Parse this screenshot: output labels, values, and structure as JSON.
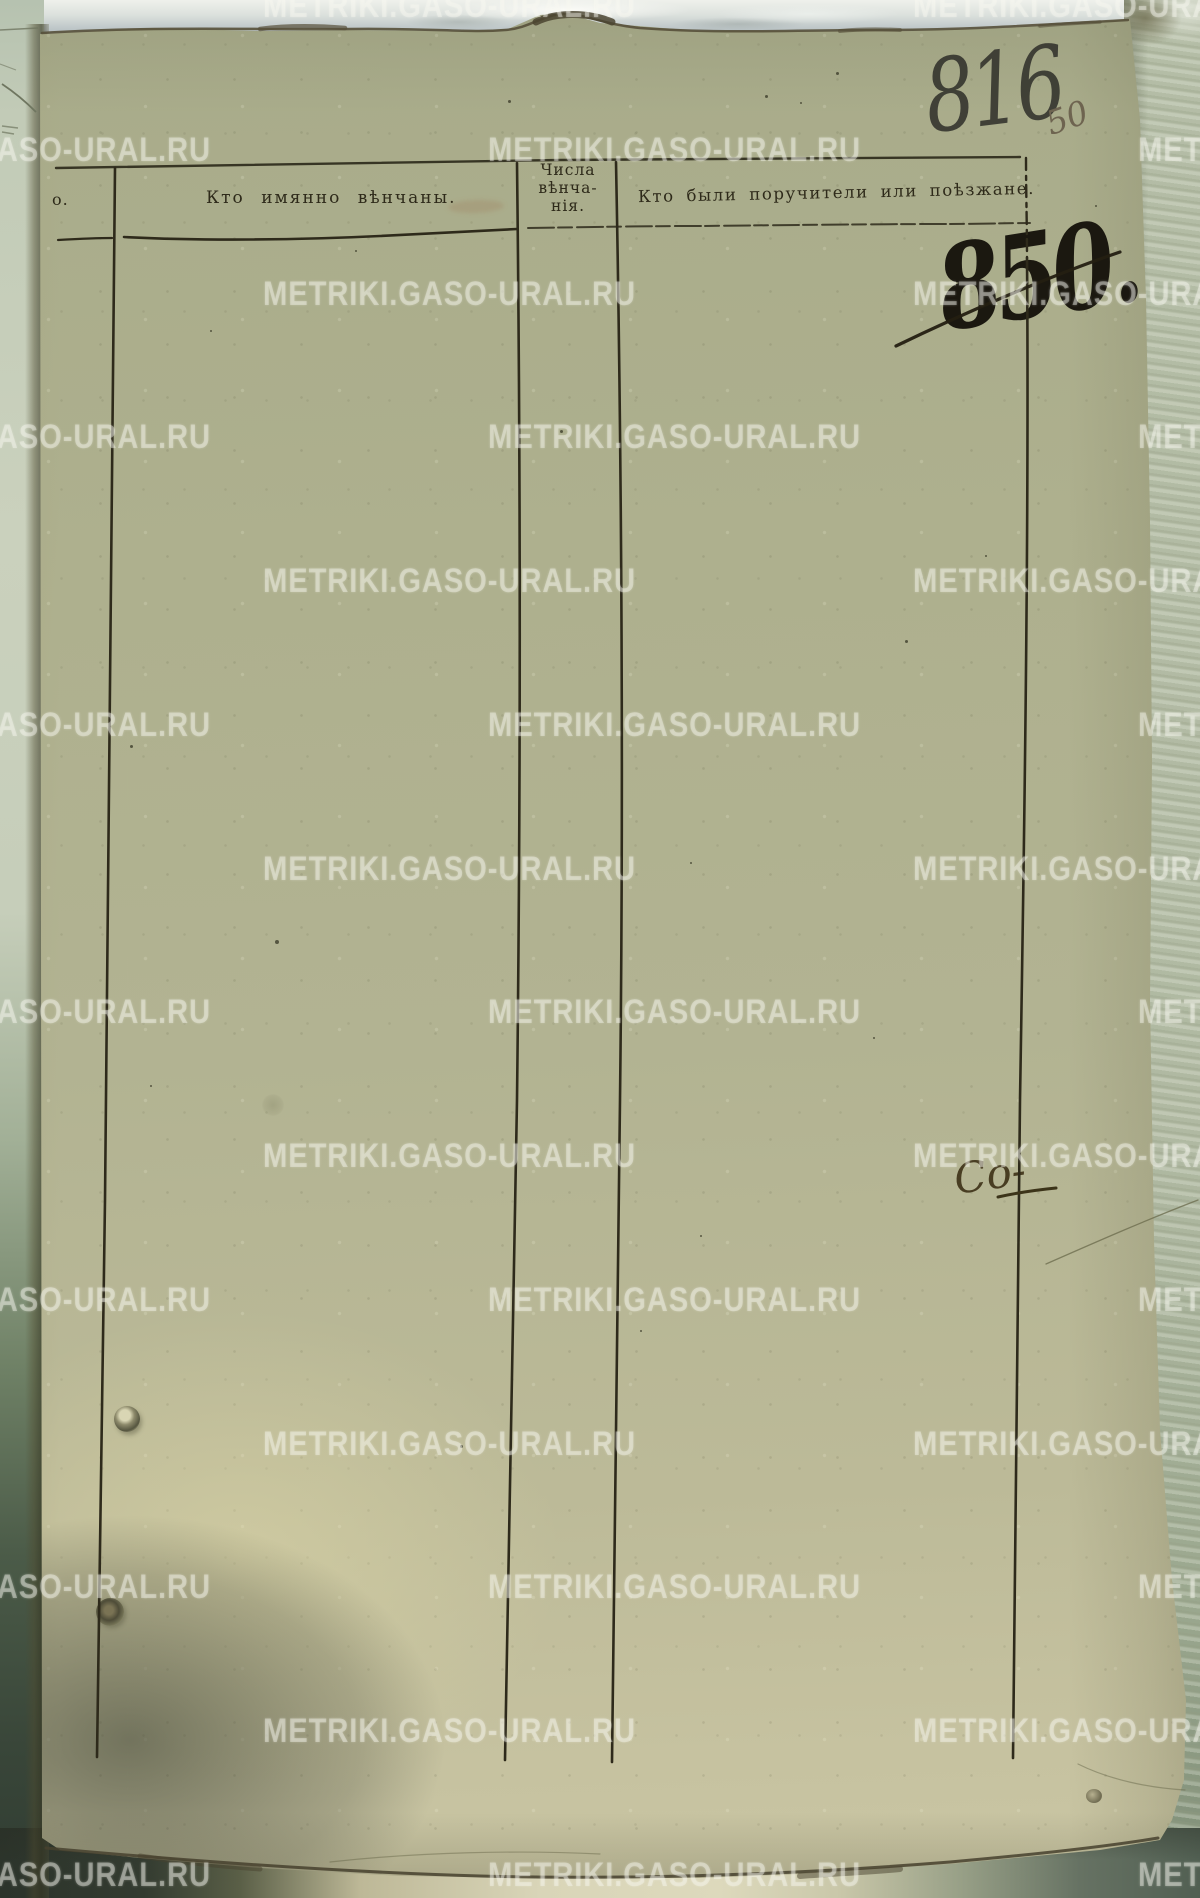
{
  "watermark": {
    "text": "METRIKI.GASO-URAL.RU"
  },
  "annotations": {
    "page_number_pencil": "816",
    "page_number_ink_small": "50",
    "crossed_out_number": "850.",
    "margin_catchword": "Со-"
  },
  "table_header": {
    "col_number_partial": "о.",
    "col_married": "Кто имянно вѣнчаны.",
    "col_date_lines": [
      "Числа",
      "вѣнча-",
      "нія."
    ],
    "col_witnesses": "Кто были поручители или поѣзжане."
  },
  "colors": {
    "paper": "#afb190",
    "ink": "#2e2a1c",
    "watermark": "rgba(247,247,240,0.40)"
  }
}
